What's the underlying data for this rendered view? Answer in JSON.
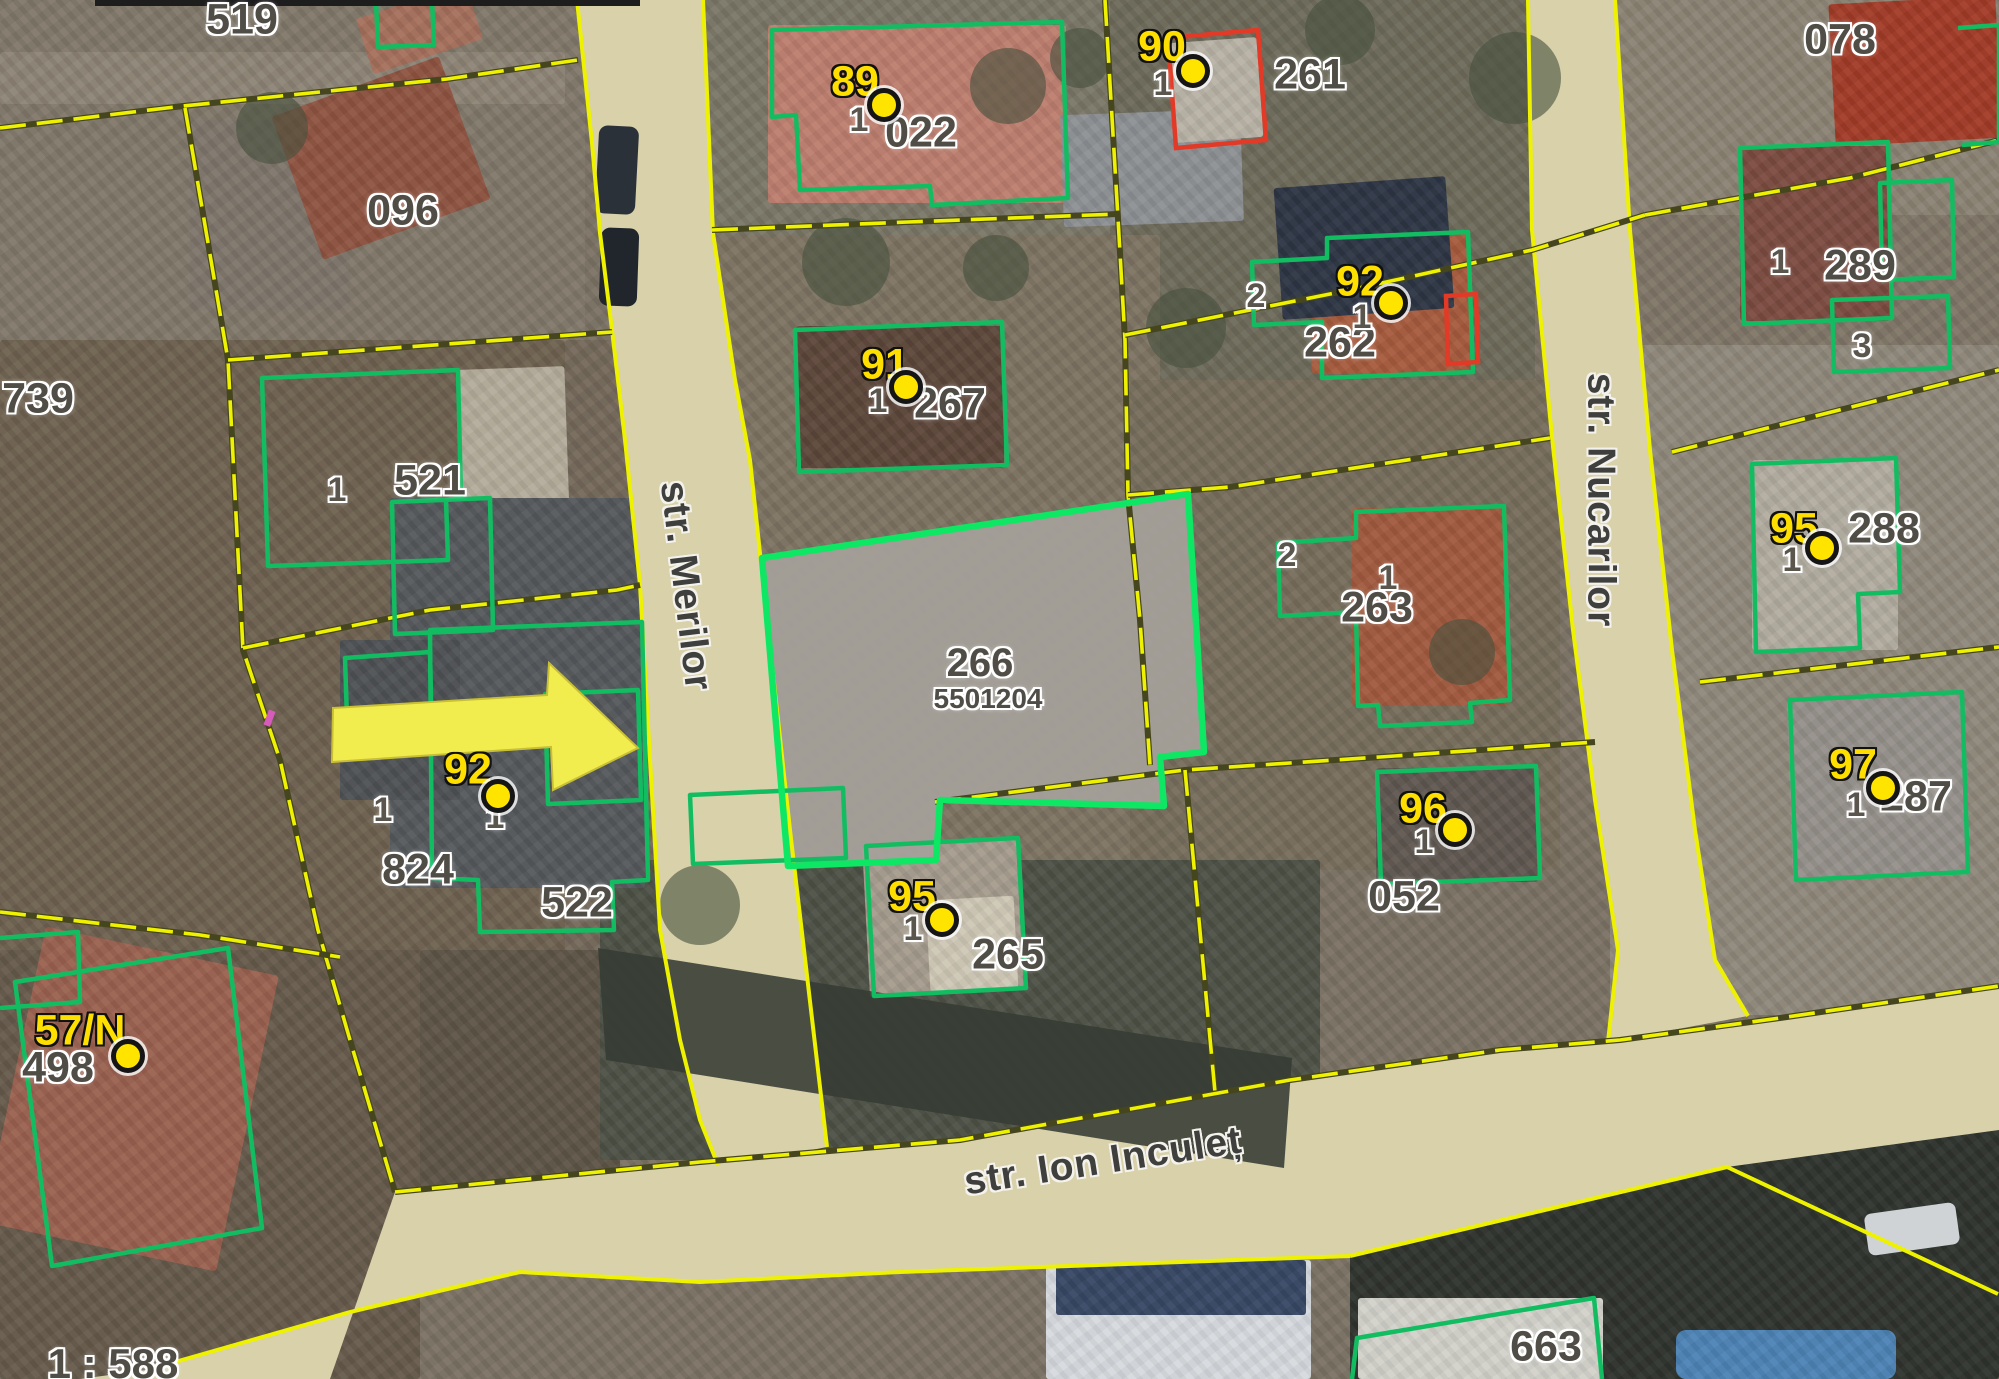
{
  "colors": {
    "parcel-line": "#eef200",
    "building-line": "#12bd62",
    "selected-line": "#0de763",
    "red-line": "#e23a26",
    "marker-fill": "#ffe400",
    "marker-text": "#ffdf00",
    "label-text": "#504d46",
    "street-text": "#3f3f3d",
    "road-fill": "#d8d1aa",
    "arrow-fill": "#f2ed4e"
  },
  "map": {
    "scale_label": "1 : 588",
    "selected_parcel": {
      "number": "266",
      "code": "5501204"
    },
    "streets": [
      {
        "name": "str. Merilor",
        "x": 686,
        "y": 586,
        "rot": 83
      },
      {
        "name": "str. Nucarilor",
        "x": 1601,
        "y": 500,
        "rot": 90
      },
      {
        "name": "str. Ion Inculeț",
        "x": 1103,
        "y": 1161,
        "rot": -8.7
      }
    ],
    "parcel_labels": [
      {
        "text": "519",
        "x": 242,
        "y": 20
      },
      {
        "text": "096",
        "x": 403,
        "y": 211
      },
      {
        "text": "739",
        "x": 38,
        "y": 399
      },
      {
        "text": "022",
        "x": 921,
        "y": 133
      },
      {
        "text": "261",
        "x": 1310,
        "y": 75
      },
      {
        "text": "078",
        "x": 1840,
        "y": 40
      },
      {
        "text": "267",
        "x": 950,
        "y": 404
      },
      {
        "text": "262",
        "x": 1340,
        "y": 343
      },
      {
        "text": "289",
        "x": 1860,
        "y": 266
      },
      {
        "text": "521",
        "x": 430,
        "y": 481
      },
      {
        "text": "288",
        "x": 1884,
        "y": 529
      },
      {
        "text": "263",
        "x": 1377,
        "y": 608
      },
      {
        "text": "824",
        "x": 418,
        "y": 870
      },
      {
        "text": "522",
        "x": 577,
        "y": 903
      },
      {
        "text": "287",
        "x": 1916,
        "y": 797
      },
      {
        "text": "052",
        "x": 1404,
        "y": 897
      },
      {
        "text": "265",
        "x": 1008,
        "y": 955
      },
      {
        "text": "498",
        "x": 58,
        "y": 1068
      },
      {
        "text": "663",
        "x": 1546,
        "y": 1347
      }
    ],
    "unit_labels": [
      {
        "text": "1",
        "x": 337,
        "y": 490
      },
      {
        "text": "1",
        "x": 859,
        "y": 120
      },
      {
        "text": "1",
        "x": 1163,
        "y": 84
      },
      {
        "text": "1",
        "x": 878,
        "y": 401
      },
      {
        "text": "1",
        "x": 1362,
        "y": 317
      },
      {
        "text": "2",
        "x": 1256,
        "y": 296
      },
      {
        "text": "1",
        "x": 1388,
        "y": 578
      },
      {
        "text": "2",
        "x": 1287,
        "y": 555
      },
      {
        "text": "1",
        "x": 383,
        "y": 810
      },
      {
        "text": "1",
        "x": 495,
        "y": 817
      },
      {
        "text": "1",
        "x": 913,
        "y": 929
      },
      {
        "text": "1",
        "x": 1424,
        "y": 842
      },
      {
        "text": "1",
        "x": 1792,
        "y": 560
      },
      {
        "text": "1",
        "x": 1856,
        "y": 805
      },
      {
        "text": "1",
        "x": 1780,
        "y": 262
      },
      {
        "text": "3",
        "x": 1862,
        "y": 346
      }
    ],
    "markers": [
      {
        "label": "89",
        "num_x": 855,
        "num_y": 82,
        "dot_x": 884,
        "dot_y": 105
      },
      {
        "label": "90",
        "num_x": 1162,
        "num_y": 47,
        "dot_x": 1193,
        "dot_y": 71
      },
      {
        "label": "91",
        "num_x": 885,
        "num_y": 365,
        "dot_x": 906,
        "dot_y": 387
      },
      {
        "label": "92",
        "num_x": 1360,
        "num_y": 282,
        "dot_x": 1391,
        "dot_y": 303
      },
      {
        "label": "92",
        "num_x": 468,
        "num_y": 770,
        "dot_x": 498,
        "dot_y": 796
      },
      {
        "label": "95",
        "num_x": 912,
        "num_y": 897,
        "dot_x": 942,
        "dot_y": 920
      },
      {
        "label": "96",
        "num_x": 1423,
        "num_y": 809,
        "dot_x": 1455,
        "dot_y": 830
      },
      {
        "label": "97",
        "num_x": 1853,
        "num_y": 765,
        "dot_x": 1883,
        "dot_y": 788
      },
      {
        "label": "95",
        "num_x": 1794,
        "num_y": 529,
        "dot_x": 1822,
        "dot_y": 548
      },
      {
        "label": "57/N",
        "num_x": 80,
        "num_y": 1031,
        "dot_x": 128,
        "dot_y": 1056
      }
    ]
  }
}
